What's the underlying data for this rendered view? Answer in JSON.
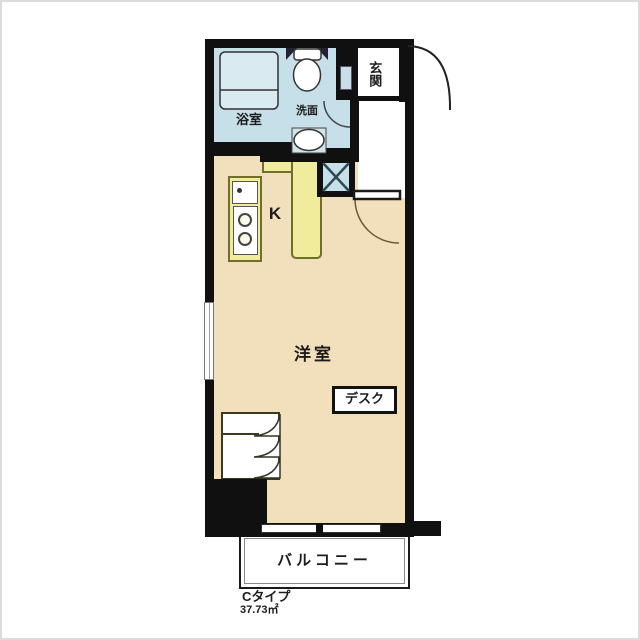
{
  "floorplan": {
    "type_label": "Cタイプ",
    "area_label": "37.73㎡",
    "labels": {
      "bathroom": "浴室",
      "washroom": "洗面",
      "entrance": "玄関",
      "kitchen": "K",
      "main_room": "洋室",
      "desk": "デスク",
      "balcony": "バルコニー"
    },
    "colors": {
      "wall": "#101010",
      "floor": "#f2e0bd",
      "wet_area": "#c6dfe8",
      "bathtub": "#d9eaf0",
      "kitchen_counter": "#f0ec9b",
      "background": "#ffffff"
    }
  }
}
